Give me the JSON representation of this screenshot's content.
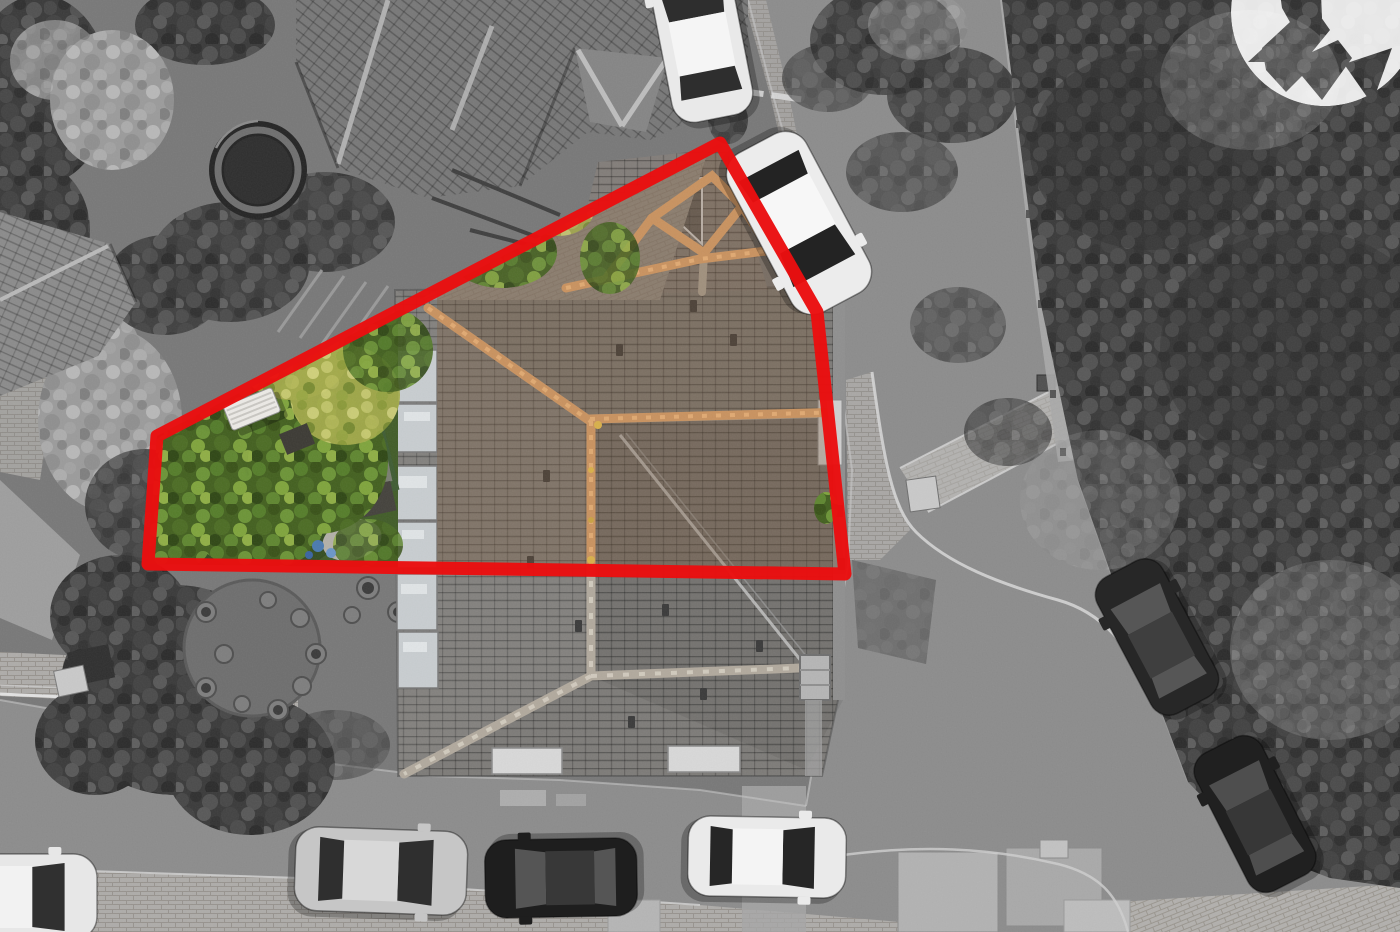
{
  "meta": {
    "type": "aerial-property-photograph",
    "style": "top-down drone photo, monochrome except the highlighted plot",
    "visible_text": "none"
  },
  "boundary": {
    "points": "720,143 817,312 845,574 148,564 157,436",
    "color": "#ea0e10",
    "stroke_width": 13,
    "opacity": 0.97
  },
  "watermark": {
    "icon": "arrow-swoosh-logo-icon",
    "fill": "#ffffff",
    "opacity": 0.88,
    "cx": 1325,
    "cy": 12,
    "r": 94
  },
  "palette": {
    "asphalt": "#8c8c8c",
    "plot_ground": "#787878",
    "sidewalk_brick": "#aeaca9",
    "foliage_grey": "#3a3a3a",
    "roof_grey": "#7d7b78",
    "ridge_grey": "#b1a99d",
    "ridge_orange": "#c9925f",
    "roof_colour_tint": "#7a5636",
    "garden_green_dark": "#2c421c",
    "garden_green": "#4f7330",
    "garden_yellow": "#b9bd5e",
    "lawn_green": "#3f5c33",
    "toy_blue": "#4a7ab0",
    "bench_white": "#eceae6",
    "boundary_red": "#ea0e10"
  },
  "scene": {
    "cars": [
      {
        "id": "car-top-white",
        "cx": 700,
        "cy": 34,
        "len": 172,
        "wid": 82,
        "rot": -11,
        "body": "#e9e9e9",
        "roof": "#f5f5f5",
        "glass": "#2e2e2e"
      },
      {
        "id": "car-street-white",
        "cx": 799,
        "cy": 223,
        "len": 180,
        "wid": 88,
        "rot": 152,
        "body": "#ececec",
        "roof": "#f7f7f7",
        "glass": "#232323"
      },
      {
        "id": "car-bottom-silver",
        "cx": 381,
        "cy": 871,
        "len": 172,
        "wid": 84,
        "rot": 92,
        "body": "#c6c6c6",
        "roof": "#d8d8d8",
        "glass": "#2f2f2f"
      },
      {
        "id": "car-bottom-black",
        "cx": 561,
        "cy": 878,
        "len": 152,
        "wid": 78,
        "rot": 269,
        "body": "#1e1e1e",
        "roof": "#383838",
        "glass": "#555555"
      },
      {
        "id": "car-bottom-white",
        "cx": 767,
        "cy": 857,
        "len": 158,
        "wid": 80,
        "rot": 91,
        "body": "#eaeaea",
        "roof": "#f4f4f4",
        "glass": "#262626"
      },
      {
        "id": "car-corner-white",
        "cx": 16,
        "cy": 897,
        "len": 162,
        "wid": 86,
        "rot": 90,
        "body": "#e7e7e7",
        "roof": "#f2f2f2",
        "glass": "#303030"
      },
      {
        "id": "car-verge-dark-1",
        "cx": 1157,
        "cy": 637,
        "len": 154,
        "wid": 74,
        "rot": -28,
        "body": "#272727",
        "roof": "#3f3f3f",
        "glass": "#565656"
      },
      {
        "id": "car-verge-dark-2",
        "cx": 1255,
        "cy": 814,
        "len": 154,
        "wid": 74,
        "rot": -27,
        "body": "#202020",
        "roof": "#373737",
        "glass": "#4e4e4e"
      }
    ],
    "landmarks": [
      {
        "id": "main-house-roof",
        "label": "hipped slate roof of the highlighted corner house"
      },
      {
        "id": "porch-roof",
        "label": "glazed porch roof with clay ridge tiles"
      },
      {
        "id": "rear-garden",
        "label": "colour-highlighted rear garden with mature green and yellow trees"
      },
      {
        "id": "garden-bench",
        "label": "white slatted garden bench"
      },
      {
        "id": "lawn",
        "label": "small dark green lawn"
      },
      {
        "id": "trampoline",
        "label": "trampoline in the neighbouring garden"
      },
      {
        "id": "pergola",
        "label": "pergola slats in the neighbouring garden"
      },
      {
        "id": "patio-pots",
        "label": "circular patio with plant pots"
      },
      {
        "id": "street",
        "label": "asphalt road curving around the plot"
      },
      {
        "id": "tree-belt",
        "label": "dense tree canopy along the east side of the road"
      }
    ]
  }
}
